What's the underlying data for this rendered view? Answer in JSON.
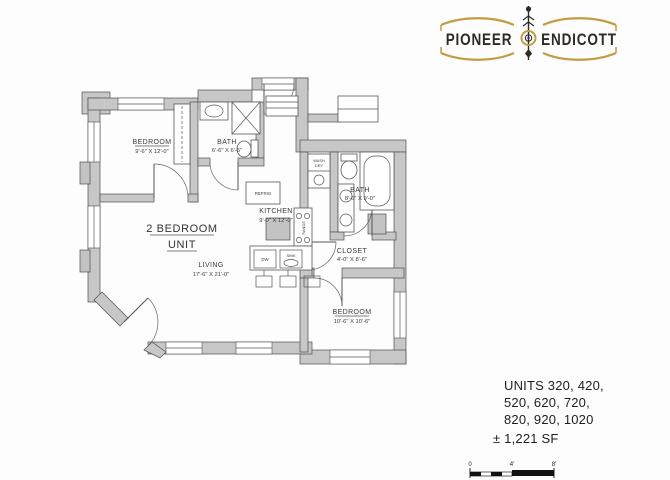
{
  "logo": {
    "word_left": "PIONEER",
    "word_right": "ENDICOTT"
  },
  "plan": {
    "unit_title_line1": "2 BEDROOM",
    "unit_title_line2": "UNIT",
    "rooms": {
      "bedroom1": {
        "name": "BEDROOM",
        "dims": "9'-6\" X 12'-0\""
      },
      "bath1": {
        "name": "BATH",
        "dims": "6'-6\" X 6'-6\""
      },
      "kitchen": {
        "name": "KITCHEN",
        "dims": "9'-0\" X 12'-0\""
      },
      "living": {
        "name": "LIVING",
        "dims": "17'-6\" X 21'-0\""
      },
      "bath2": {
        "name": "BATH",
        "dims": "8'-6\" X 9'-0\""
      },
      "closet": {
        "name": "CLOSET",
        "dims": "4'-0\" X 8'-6\""
      },
      "bedroom2": {
        "name": "BEDROOM",
        "dims": "10'-6\" X 10'-6\""
      }
    },
    "fixtures": {
      "refrigerator": "REFRIG",
      "range": "RANGE",
      "dishwasher": "DW",
      "sink": "SINK",
      "washer_dryer_line1": "WASH",
      "washer_dryer_line2": "DRY"
    }
  },
  "info": {
    "units_line1": "UNITS 320, 420,",
    "units_line2": "520, 620, 720,",
    "units_line3": "820, 920, 1020",
    "area": "± 1,221 SF"
  },
  "scale_bar": {
    "start": "0",
    "mid": "4'",
    "end": "8'"
  },
  "colors": {
    "wall_fill": "#c7c7c7",
    "line": "#4f4f4f",
    "logo_gold": "#c49b41",
    "logo_ink": "#2e2a25"
  }
}
